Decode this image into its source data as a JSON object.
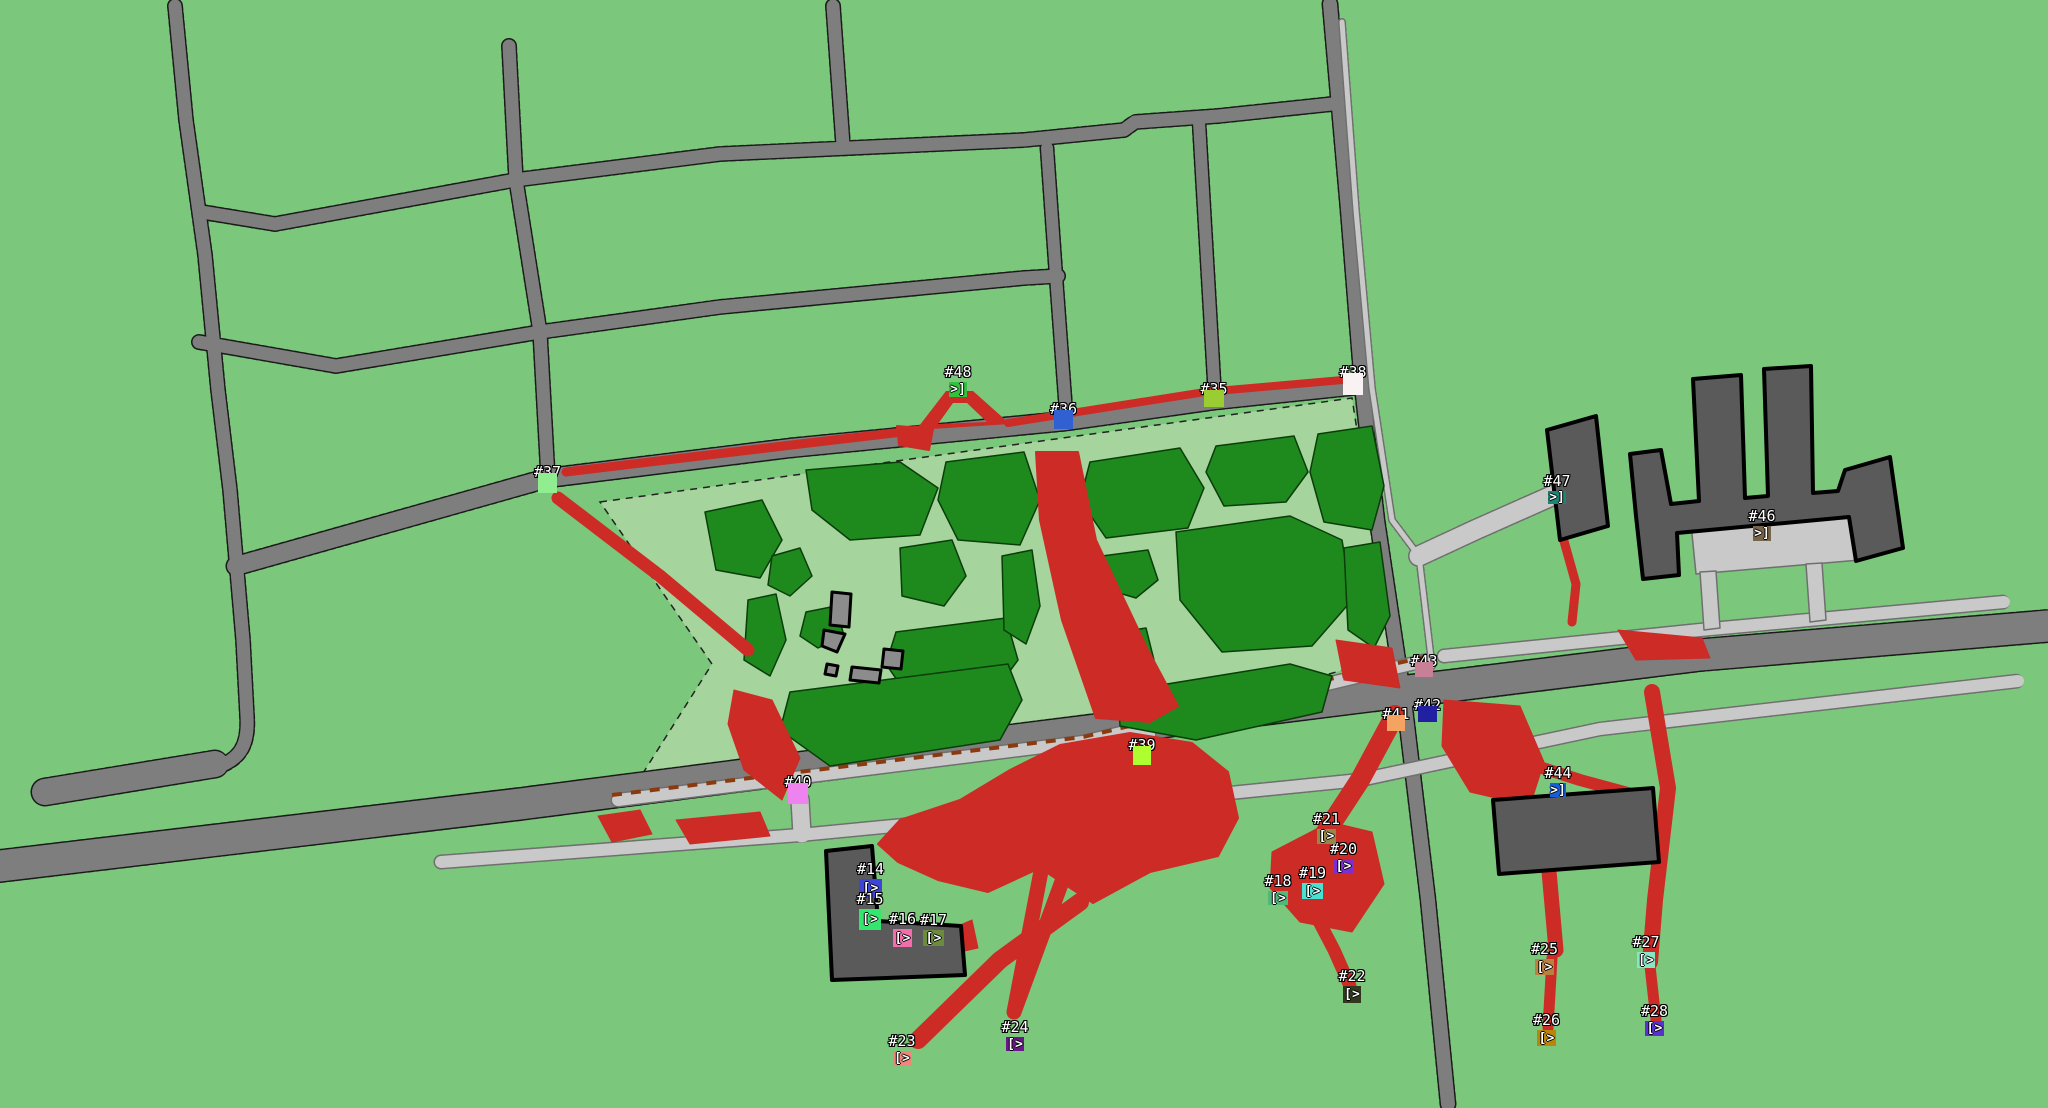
{
  "palette": {
    "background": "#7BC77B",
    "park": "#A5D59C",
    "tree": "#1E8A1E",
    "tree_outline": "#0A3D0A",
    "road": "#7E7E7E",
    "road_edge": "#1A1A1A",
    "light_road": "#C9C9C9",
    "light_road_edge": "#6F6F6F",
    "building": "#5A5A5A",
    "building_outline": "#000000",
    "shed": "#8C8C8C",
    "trail": "#CC2B26",
    "dashed_route": "#8B3A10",
    "marker_label_color": "#FFFFFF"
  },
  "markers": [
    {
      "id": "14",
      "label": "#14",
      "glyph": "[>",
      "color": "#3C45D6",
      "x": 859,
      "y": 879,
      "w": 23,
      "h": 19
    },
    {
      "id": "15",
      "label": "#15",
      "glyph": "[>",
      "color": "#34E66E",
      "x": 859,
      "y": 909,
      "w": 22,
      "h": 21
    },
    {
      "id": "16",
      "label": "#16",
      "glyph": "[>",
      "color": "#F06EAA",
      "x": 893,
      "y": 929,
      "w": 19,
      "h": 18
    },
    {
      "id": "17",
      "label": "#17",
      "glyph": "[>",
      "color": "#6A8C3C",
      "x": 923,
      "y": 930,
      "w": 21,
      "h": 16
    },
    {
      "id": "18",
      "label": "#18",
      "glyph": "[>",
      "color": "#50B978",
      "x": 1268,
      "y": 891,
      "w": 20,
      "h": 14
    },
    {
      "id": "19",
      "label": "#19",
      "glyph": "[>",
      "color": "#48E0D0",
      "x": 1302,
      "y": 883,
      "w": 21,
      "h": 16
    },
    {
      "id": "20",
      "label": "#20",
      "glyph": "[>",
      "color": "#7D2DD2",
      "x": 1334,
      "y": 859,
      "w": 19,
      "h": 15
    },
    {
      "id": "21",
      "label": "#21",
      "glyph": "[>",
      "color": "#968648",
      "x": 1317,
      "y": 829,
      "w": 19,
      "h": 15
    },
    {
      "id": "22",
      "label": "#22",
      "glyph": "[>",
      "color": "#32381E",
      "x": 1343,
      "y": 986,
      "w": 18,
      "h": 17
    },
    {
      "id": "23",
      "label": "#23",
      "glyph": "[>",
      "color": "#F08678",
      "x": 893,
      "y": 1051,
      "w": 18,
      "h": 15
    },
    {
      "id": "24",
      "label": "#24",
      "glyph": "[>",
      "color": "#691987",
      "x": 1006,
      "y": 1037,
      "w": 18,
      "h": 14
    },
    {
      "id": "25",
      "label": "#25",
      "glyph": "[>",
      "color": "#BA8040",
      "x": 1535,
      "y": 959,
      "w": 19,
      "h": 16
    },
    {
      "id": "26",
      "label": "#26",
      "glyph": "[>",
      "color": "#B8860B",
      "x": 1537,
      "y": 1030,
      "w": 19,
      "h": 16
    },
    {
      "id": "27",
      "label": "#27",
      "glyph": "[>",
      "color": "#87E6C3",
      "x": 1637,
      "y": 952,
      "w": 18,
      "h": 16
    },
    {
      "id": "28",
      "label": "#28",
      "glyph": "[>",
      "color": "#5A30D0",
      "x": 1645,
      "y": 1021,
      "w": 19,
      "h": 15
    },
    {
      "id": "35",
      "label": "#35",
      "glyph": "",
      "color": "#9ACD32",
      "x": 1204,
      "y": 390,
      "w": 20,
      "h": 17
    },
    {
      "id": "36",
      "label": "#36",
      "glyph": "",
      "color": "#3060D2",
      "x": 1054,
      "y": 410,
      "w": 19,
      "h": 19
    },
    {
      "id": "37",
      "label": "#37",
      "glyph": "",
      "color": "#90EE90",
      "x": 538,
      "y": 473,
      "w": 19,
      "h": 20
    },
    {
      "id": "38",
      "label": "#38",
      "glyph": "",
      "color": "#F8F2F2",
      "x": 1343,
      "y": 373,
      "w": 20,
      "h": 22
    },
    {
      "id": "39",
      "label": "#39",
      "glyph": "",
      "color": "#ADFF2F",
      "x": 1133,
      "y": 746,
      "w": 18,
      "h": 19
    },
    {
      "id": "40",
      "label": "#40",
      "glyph": "",
      "color": "#EE82EE",
      "x": 788,
      "y": 783,
      "w": 20,
      "h": 21
    },
    {
      "id": "41",
      "label": "#41",
      "glyph": "",
      "color": "#F4A460",
      "x": 1387,
      "y": 715,
      "w": 18,
      "h": 16
    },
    {
      "id": "42",
      "label": "#42",
      "glyph": "",
      "color": "#2020A0",
      "x": 1418,
      "y": 706,
      "w": 19,
      "h": 16
    },
    {
      "id": "43",
      "label": "#43",
      "glyph": "",
      "color": "#C88096",
      "x": 1415,
      "y": 662,
      "w": 18,
      "h": 15
    },
    {
      "id": "44",
      "label": "#44",
      "glyph": ">]",
      "color": "#1560D8",
      "x": 1550,
      "y": 783,
      "w": 16,
      "h": 14
    },
    {
      "id": "46",
      "label": "#46",
      "glyph": ">]",
      "color": "#786448",
      "x": 1753,
      "y": 526,
      "w": 18,
      "h": 15
    },
    {
      "id": "47",
      "label": "#47",
      "glyph": ">]",
      "color": "#1A8676",
      "x": 1548,
      "y": 491,
      "w": 18,
      "h": 13
    },
    {
      "id": "48",
      "label": "#48",
      "glyph": ">]",
      "color": "#32C33C",
      "x": 949,
      "y": 382,
      "w": 18,
      "h": 15
    }
  ]
}
